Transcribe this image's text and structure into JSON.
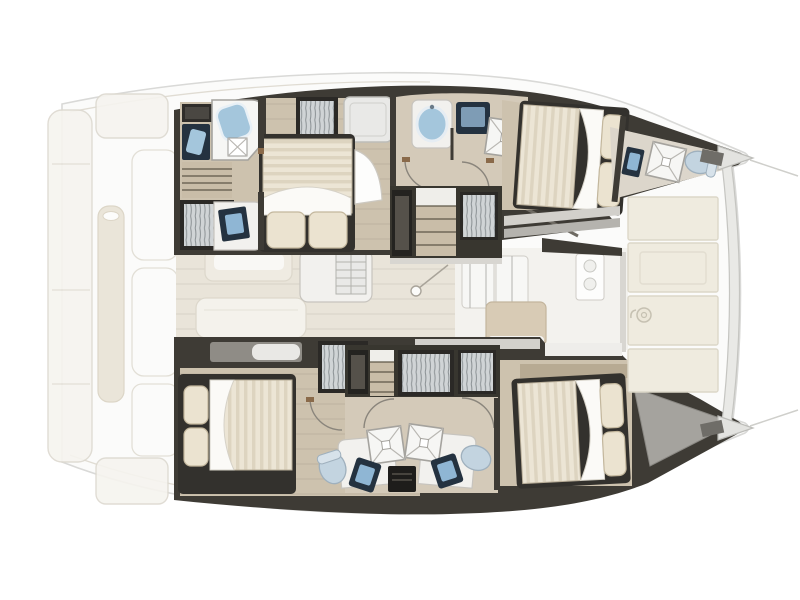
{
  "page": {
    "title": "Catamaran yacht layout plan",
    "background": "#ffffff"
  },
  "plan": {
    "type": "yacht-floor-plan",
    "view": "top-down",
    "orientation": "bow pointing right, stern at left",
    "vessel_type": "sailing catamaran",
    "areas": {
      "aft_deck": [
        "swim platform",
        "transom steps",
        "aft bench",
        "cockpit table",
        "cockpit sofa"
      ],
      "salon": [
        "dining table",
        "sofa",
        "galley unit with fridge",
        "storage cabinets",
        "stove with two burners",
        "galley island",
        "mast foot"
      ],
      "port_hull": [
        "aft bathroom with glass shower and two sinks",
        "wardrobes",
        "aft double cabin with island bed",
        "escape hatch",
        "mid bathroom with oval sink and shower",
        "companionway stairs",
        "forward double cabin",
        "bow bathroom with sink, shower and toilet"
      ],
      "starboard_hull": [
        "aft double cabin with island bed",
        "aft bathroom with shower, sink and toilet",
        "companionway stairs",
        "wardrobes",
        "forward bathroom with shower, sink and toilet",
        "forward double cabin",
        "bow deck locker"
      ],
      "foredeck": [
        "four lounge cushion panels",
        "windlass",
        "forward crossbeam",
        "two bow points with bridle lines"
      ]
    },
    "counts": {
      "double_beds": 4,
      "showers": 5,
      "toilets": 3,
      "sinks": 7,
      "wardrobes": 6,
      "staircases": 3
    }
  },
  "colors": {
    "background": "#ffffff",
    "silhouette_fill": "#fbfbfa",
    "silhouette_stroke": "#d9d9d7",
    "hull_wall": "#3e3b35",
    "hull_wall_light": "#57534b",
    "cabin_floor": "#cdc2ae",
    "cabin_floor_light": "#d4cab9",
    "salon_floor": "#e9e4d9",
    "salon_floor_fwd": "#f3f2ee",
    "mattress": "#ece5d5",
    "mattress_stripe": "#d9d0bb",
    "duvet": "#fbfaf7",
    "pillow": "#ebe3d0",
    "wardrobe_bg": "#d0d4d6",
    "wardrobe_stripe": "#8b9194",
    "stair_tread": "#c9bda8",
    "shower_white": "#f6f6f4",
    "basin_blue": "#a4c6dc",
    "console_dark": "#243240",
    "toilet_blue": "#c3d4e0",
    "counter_white": "#f2f1ee",
    "ghost_fill": "#f3f1ec",
    "ghost_tan": "#e9e3d6",
    "foredeck_panel": "#efebdf",
    "deck_gray": "#a5a39e",
    "threshold_gray": "#d8d6d1",
    "shelf_tan": "#b7aa93",
    "island_tan": "#d8cbb5",
    "beam_fill": "#e9e9e6"
  }
}
